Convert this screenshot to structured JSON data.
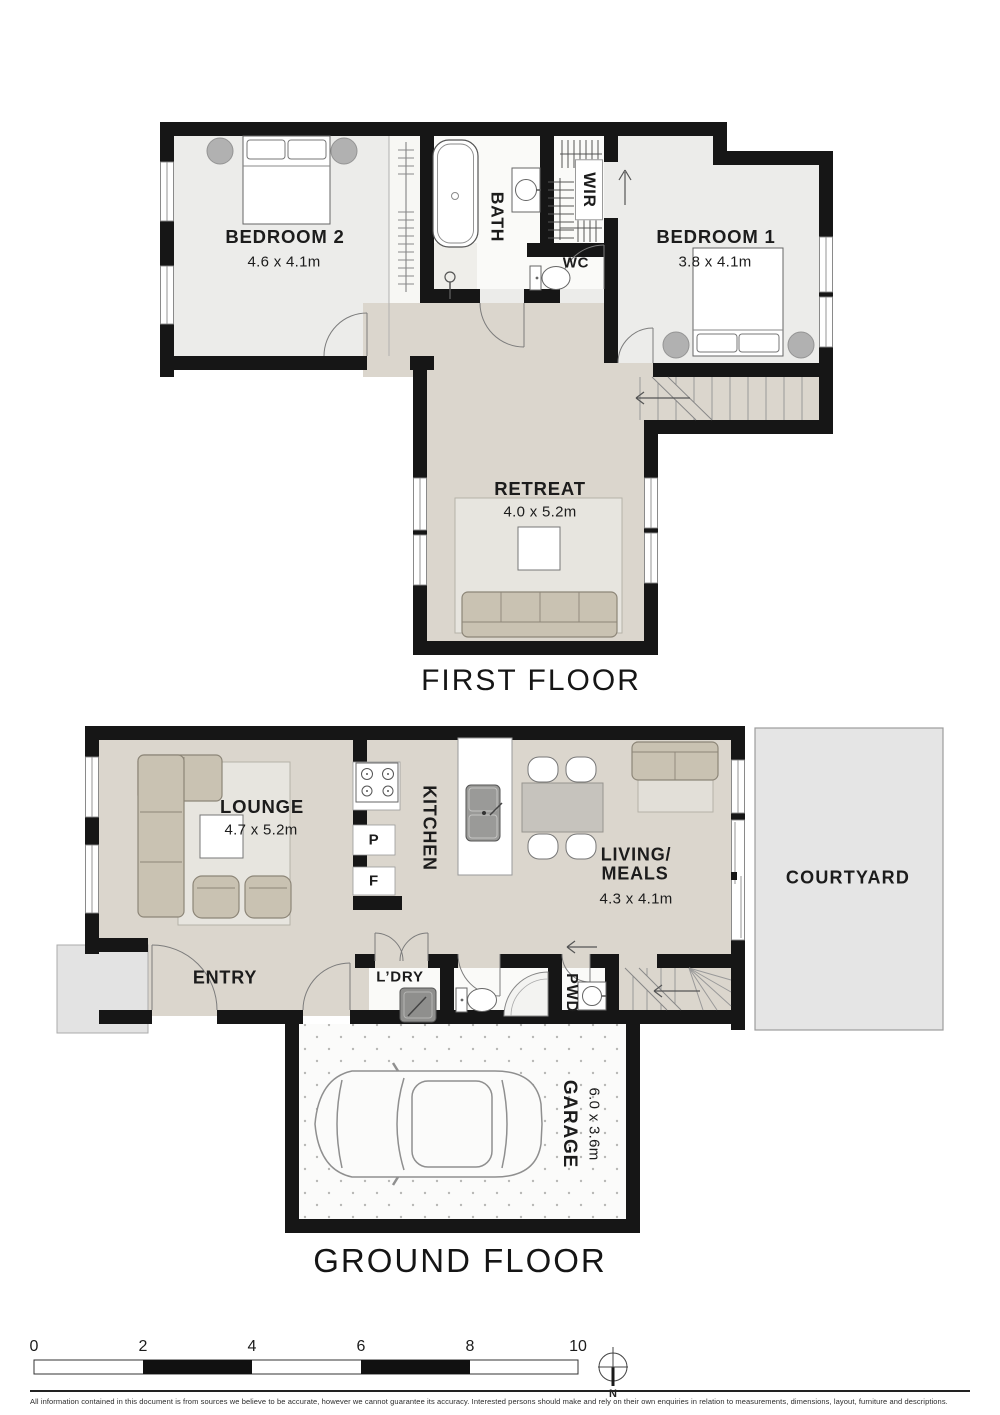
{
  "colors": {
    "wall": "#161616",
    "floor_gray": "#ececea",
    "floor_beige": "#dbd6cd",
    "floor_white": "#fafaf8",
    "courtyard": "#e5e5e5",
    "furniture": "#c9c2b2",
    "nightstand": "#b1b1b1"
  },
  "first_floor": {
    "title": "FIRST FLOOR",
    "rooms": {
      "bedroom2": {
        "name": "BEDROOM 2",
        "dims": "4.6 x 4.1m"
      },
      "bath": {
        "name": "BATH"
      },
      "wir": {
        "name": "WIR"
      },
      "wc": {
        "name": "WC"
      },
      "bedroom1": {
        "name": "BEDROOM 1",
        "dims": "3.8 x 4.1m"
      },
      "retreat": {
        "name": "RETREAT",
        "dims": "4.0 x 5.2m"
      }
    }
  },
  "ground_floor": {
    "title": "GROUND FLOOR",
    "rooms": {
      "lounge": {
        "name": "LOUNGE",
        "dims": "4.7 x 5.2m"
      },
      "kitchen": {
        "name": "KITCHEN"
      },
      "pantry": {
        "name": "P"
      },
      "fridge": {
        "name": "F"
      },
      "living_meals": {
        "line1": "LIVING/",
        "line2": "MEALS",
        "dims": "4.3 x 4.1m"
      },
      "courtyard": {
        "name": "COURTYARD"
      },
      "entry": {
        "name": "ENTRY"
      },
      "laundry": {
        "name": "L’DRY"
      },
      "powder": {
        "name": "PWD"
      },
      "garage": {
        "name": "GARAGE",
        "dims": "6.0 x 3.6m"
      }
    }
  },
  "scale_bar": {
    "labels": [
      "0",
      "2",
      "4",
      "6",
      "8",
      "10"
    ]
  },
  "compass": {
    "north_label": "N"
  },
  "disclaimer": "All information contained in this document is from sources we believe to be accurate, however we cannot guarantee its accuracy. Interested persons should make and rely on their own enquiries in relation to measurements, dimensions, layout, furniture and descriptions."
}
